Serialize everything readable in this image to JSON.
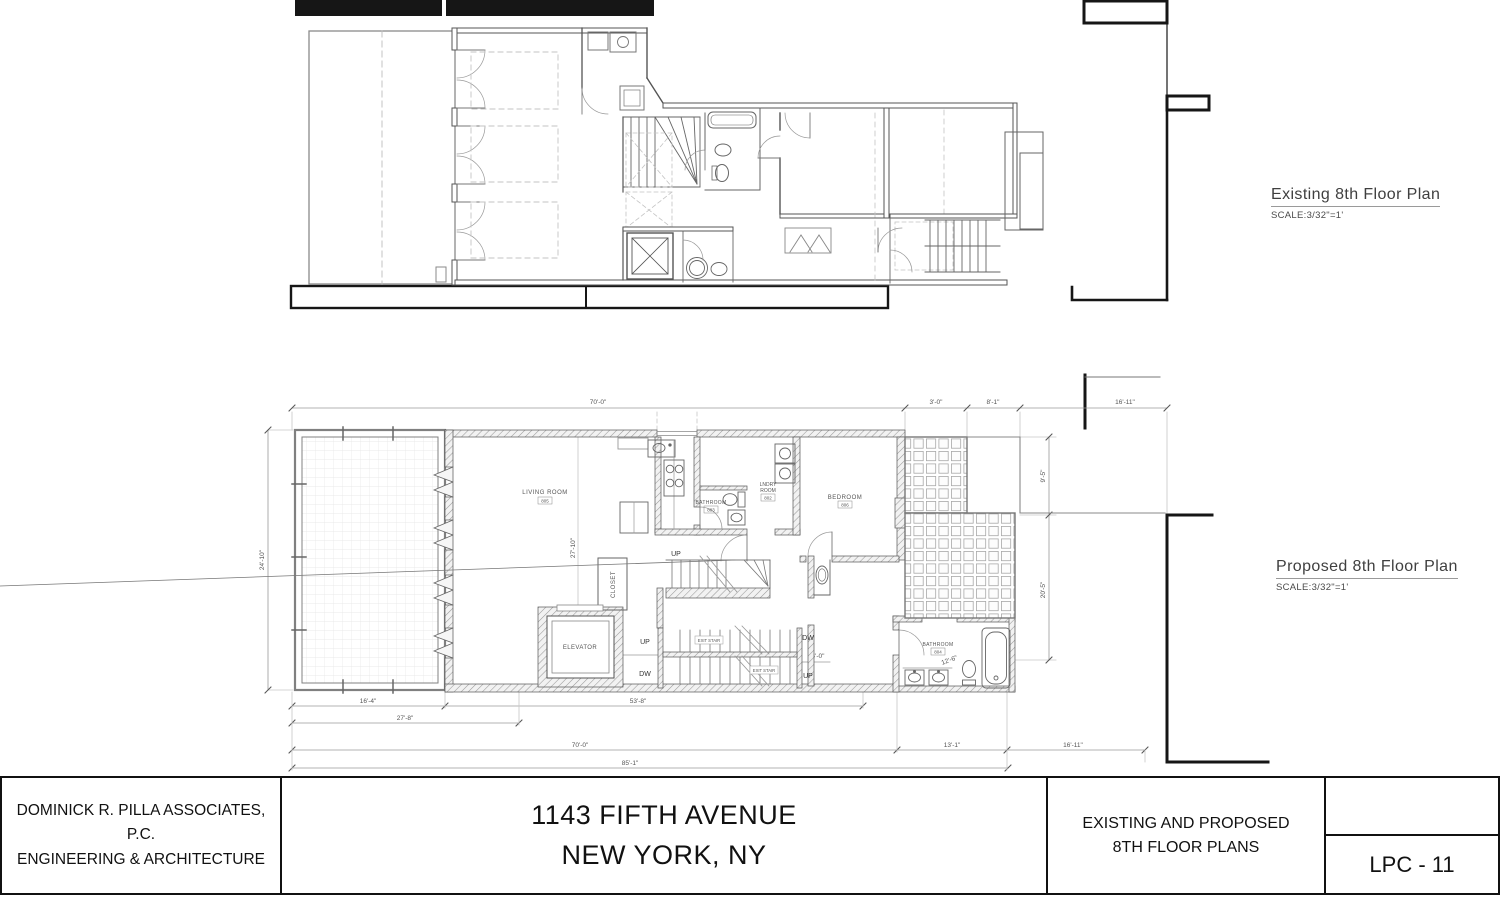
{
  "labels": {
    "existing": {
      "title": "Existing 8th Floor Plan",
      "scale": "SCALE:3/32\"=1'"
    },
    "proposed": {
      "title": "Proposed 8th Floor Plan",
      "scale": "SCALE:3/32\"=1'"
    }
  },
  "title_block": {
    "firm_line1": "DOMINICK R. PILLA ASSOCIATES, P.C.",
    "firm_line2": "ENGINEERING & ARCHITECTURE",
    "project_line1": "1143 FIFTH AVENUE",
    "project_line2": "NEW YORK, NY",
    "sheet_line1": "EXISTING AND PROPOSED",
    "sheet_line2": "8TH FLOOR PLANS",
    "sheet_number": "LPC - 11"
  },
  "plan": {
    "rooms": {
      "living": {
        "name": "LIVING ROOM",
        "tag": "805"
      },
      "bath_center": {
        "name": "BATHROOM",
        "tag": "803"
      },
      "laundry": {
        "line1": "LNDRY",
        "line2": "ROOM",
        "tag": "802"
      },
      "bedroom": {
        "name": "BEDROOM",
        "tag": "806"
      },
      "bath_master": {
        "name": "BATHROOM",
        "tag": "804"
      },
      "elevator": "ELEVATOR",
      "closet": "CLOSET"
    },
    "stairs": {
      "up": "UP",
      "down": "DW",
      "exit": "EXIT STAIR"
    },
    "dims": {
      "top_overall": "70'-0\"",
      "top_1": "3'-0\"",
      "top_2": "8'-1\"",
      "top_3": "16'-11\"",
      "b1a": "16'-4\"",
      "b1b": "53'-8\"",
      "b2": "27'-8\"",
      "b3a": "70'-0\"",
      "b3b": "13'-1\"",
      "b3c": "16'-11\"",
      "b4": "85'-1\"",
      "left": "24'-10\"",
      "interior": "27'-10\"",
      "right_top": "9'-5\"",
      "right_bottom": "20'-5\"",
      "stair": "4'-0\"",
      "hall": "4'-0\"",
      "bath_diag": "12'-6\""
    }
  }
}
